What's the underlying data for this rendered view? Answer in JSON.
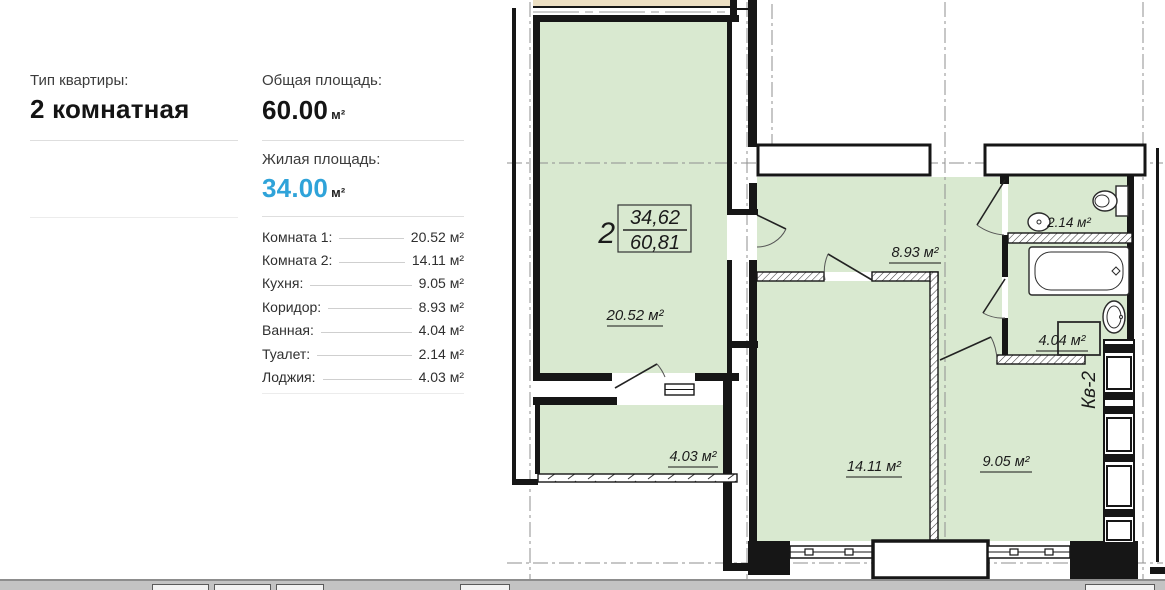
{
  "accent_blue": "#2fa3d9",
  "room_green": "#d9e9d0",
  "info": {
    "type_label": "Тип квартиры:",
    "type_value": "2 комнатная",
    "total_label": "Общая площадь:",
    "total_value": "60.00",
    "total_unit": "м²",
    "living_label": "Жилая площадь:",
    "living_value": "34.00",
    "living_unit": "м²",
    "rooms": [
      {
        "label": "Комната 1:",
        "value": "20.52 м²"
      },
      {
        "label": "Комната 2:",
        "value": "14.11 м²"
      },
      {
        "label": "Кухня:",
        "value": "9.05 м²"
      },
      {
        "label": "Коридор:",
        "value": "8.93 м²"
      },
      {
        "label": "Ванная:",
        "value": "4.04 м²"
      },
      {
        "label": "Туалет:",
        "value": "2.14 м²"
      },
      {
        "label": "Лоджия:",
        "value": "4.03 м²"
      }
    ]
  },
  "plan": {
    "unit_number": "2",
    "frac_top": "34,62",
    "frac_bottom": "60,81",
    "kv_label": "Кв-2",
    "labels": {
      "room1": "20.52 м²",
      "loggia": "4.03 м²",
      "corridor": "8.93 м²",
      "room2": "14.11 м²",
      "kitchen": "9.05 м²",
      "wc": "2.14 м²",
      "bath": "4.04 м²"
    }
  }
}
